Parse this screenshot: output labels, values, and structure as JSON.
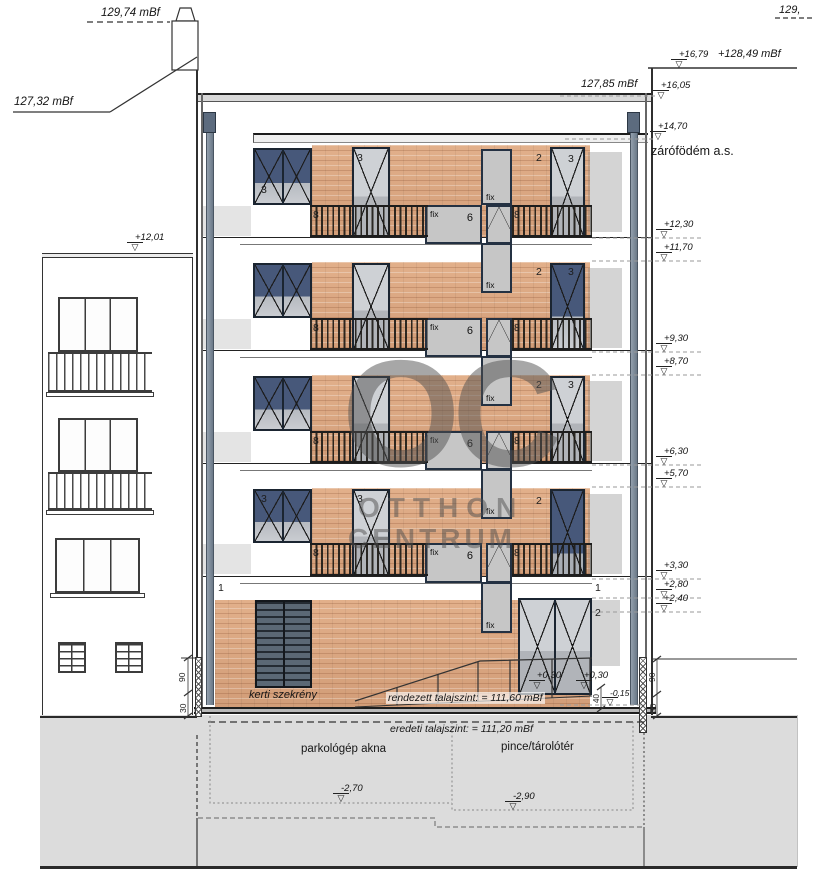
{
  "annotations": {
    "neighbor_chimney_level": "129,74 mBf",
    "neighbor_eaves_level": "127,32 mBf",
    "neighbor_roof_marker": "+12,01",
    "corner_partial_level": "129,",
    "parapet_marker": "+16,79",
    "parapet_level": "+128,49 mBf",
    "attic_marker": "+16,05",
    "attic_level": "127,85 mBf",
    "roof_slab_marker": "+14,70",
    "roof_slab_label": "zárófödém a.s."
  },
  "level_markers": [
    "+12,30",
    "+11,70",
    "+9,30",
    "+8,70",
    "+6,30",
    "+5,70",
    "+3,30",
    "+2,80",
    "+2,40"
  ],
  "floor_tags": {
    "f4_left_door": "3",
    "f4_tall_door": "3",
    "f4_right_a": "2",
    "f4_right_b": "3",
    "f3_right_a": "2",
    "f3_right_b": "3",
    "f2_right_a": "2",
    "f2_right_b": "3",
    "f1_left_door": "3",
    "f1_tall_door": "3",
    "f1_right_a": "2"
  },
  "rail_tags": {
    "left": "8",
    "fix": "fix",
    "mid": "6",
    "right": "8"
  },
  "stair_window_tag": "fix",
  "ground": {
    "layer_tag_left": "1",
    "layer_tag_right_a": "1",
    "layer_tag_right_b": "2",
    "cabinet_label": "kerti szekrény",
    "threshold_a": "+0,30",
    "threshold_b": "+0,30",
    "dim_40": "40",
    "street_level": "-0,15",
    "finished_grade": "rendezett talajszint: = 111,60 mBf"
  },
  "dims": {
    "left_90": "90",
    "left_30": "30",
    "right_90": "90",
    "right_30": "30"
  },
  "basement": {
    "original_grade": "eredeti talajszint: = 111,20 mBf",
    "room_left": "parkológép akna",
    "room_right": "pince/tárolótér",
    "depth_left": "-2,70",
    "depth_right": "-2,90"
  },
  "watermark": {
    "big": "OC",
    "line1": "OTTHON",
    "line2": "CENTRUM"
  },
  "colors": {
    "brick": "#d8a47e",
    "window_navy": "#47587a",
    "frame": "#1b2531",
    "ground": "#dcdcdc"
  }
}
